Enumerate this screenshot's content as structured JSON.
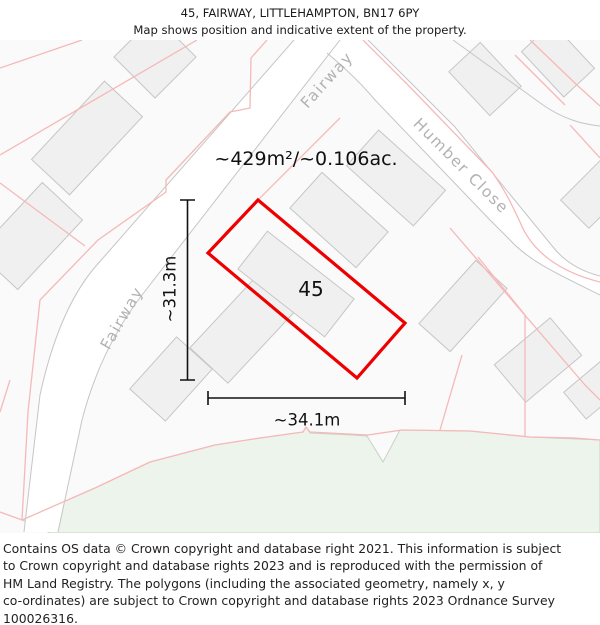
{
  "title": {
    "line1": "45, FAIRWAY, LITTLEHAMPTON, BN17 6PY",
    "line2": "Map shows position and indicative extent of the property."
  },
  "map": {
    "area_label": "~429m²/~0.106ac.",
    "plot_label": "45",
    "dim_width": "~34.1m",
    "dim_height": "~31.3m",
    "roads": {
      "fairway": "Fairway",
      "fairway2": "Fairway",
      "humber": "Humber Close"
    },
    "colors": {
      "property_outline": "#ee0000",
      "parcel_boundary": "#f6b8b8",
      "green_area": "#edf4ec",
      "building_fill": "#f0f0f0",
      "road_edge": "#c5c5c5",
      "road_label": "#b2b2b2",
      "map_background": "#fafafa"
    }
  },
  "footer": {
    "lines": [
      "Contains OS data © Crown copyright and database right 2021. This information is subject",
      "to Crown copyright and database rights 2023 and is reproduced with the permission of",
      "HM Land Registry. The polygons (including the associated geometry, namely x, y",
      "co-ordinates) are subject to Crown copyright and database rights 2023 Ordnance Survey",
      "100026316."
    ]
  }
}
